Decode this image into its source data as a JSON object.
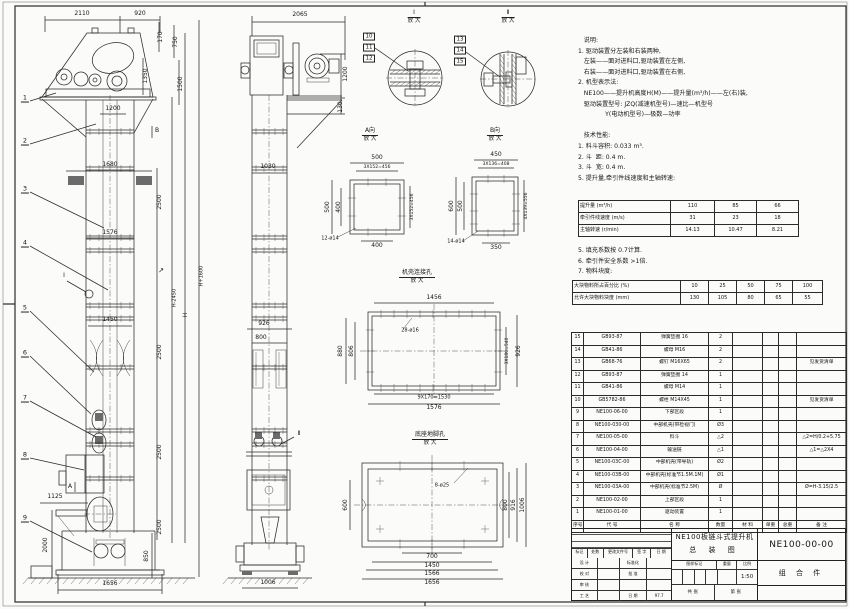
{
  "colors": {
    "line": "#2b2b2b",
    "paper": "#fbfbf9",
    "bracket_fill": "#6b6b6b"
  },
  "notes": {
    "block1_lines": [
      "   说明:",
      "1. 驱动装置分左装和右装两种,",
      "   左装——面对进料口,驱动装置在左侧,",
      "   右装——面对进料口,驱动装置在右侧,",
      "2. 机型表示法:",
      "   NE100——提升机高度H(M)——提升量(m³/h)——左(右)装,",
      "   驱动装置型号: JZQ(减速机型号)—速比—机型号",
      "              Y(电动机型号)—极数—功率",
      "",
      "   技术性能:",
      "1. 料斗容积: 0.033 m³.",
      "2. 斗  距: 0.4 m.",
      "3. 斗  宽: 0.4 m.",
      "5. 提升量,牵引件线速度和主轴转速:"
    ],
    "block2_lines": [
      "5. 填充系数按 0.7计算.",
      "6. 牵引件安全系数 >1倍.",
      "7. 物料块度:"
    ]
  },
  "chart_data": [
    {
      "type": "table",
      "title": "提升量,牵引件线速度和主轴转速",
      "rows": [
        [
          "提升量 (m³/h)",
          "110",
          "85",
          "66"
        ],
        [
          "牵引件线速度 (m/s)",
          "31",
          "23",
          "18"
        ],
        [
          "主轴转速 (r/min)",
          "14.13",
          "10.47",
          "8.21"
        ]
      ]
    },
    {
      "type": "table",
      "title": "物料块度",
      "rows": [
        [
          "大块物料所占百分比 (%)",
          "10",
          "25",
          "50",
          "75",
          "100"
        ],
        [
          "允许大块物料块度 (mm)",
          "130",
          "105",
          "80",
          "65",
          "55"
        ]
      ]
    }
  ],
  "bom": {
    "header": [
      "序号",
      "代 号",
      "名  称",
      "数量",
      "材 料",
      "单重",
      "总重",
      "备 注"
    ],
    "col_widths": [
      12,
      57,
      68,
      24,
      30,
      16,
      18,
      50
    ],
    "rows": [
      [
        "15",
        "GB93-87",
        "弹簧垫圈 16",
        "2",
        "",
        "",
        "",
        ""
      ],
      [
        "14",
        "GB41-86",
        "螺母 M16",
        "2",
        "",
        "",
        "",
        ""
      ],
      [
        "13",
        "GB68-76",
        "螺钉 M16X65",
        "2",
        "",
        "",
        "",
        "见发货清单"
      ],
      [
        "12",
        "GB93-87",
        "弹簧垫圈 14",
        "1",
        "",
        "",
        "",
        ""
      ],
      [
        "11",
        "GB41-86",
        "螺母 M14",
        "1",
        "",
        "",
        "",
        ""
      ],
      [
        "10",
        "GB5782-86",
        "螺栓 M14X45",
        "1",
        "",
        "",
        "",
        "见发货清单"
      ],
      [
        "9",
        "NE100-06-00",
        "下部区段",
        "1",
        "",
        "",
        "",
        ""
      ],
      [
        "8",
        "NE100-030-00",
        "中部机壳(带检视门)",
        "Ø3",
        "",
        "",
        "",
        ""
      ],
      [
        "7",
        "NE100-05-00",
        "料斗",
        "△2",
        "",
        "",
        "",
        "△2=H/0.2+5.75"
      ],
      [
        "6",
        "NE100-04-00",
        "输送链",
        "△1",
        "",
        "",
        "",
        "△1=△2X4"
      ],
      [
        "5",
        "NE100-03C-00",
        "中部机壳(带导轨)",
        "Ø2",
        "",
        "",
        "",
        ""
      ],
      [
        "4",
        "NE100-03B-00",
        "中部机壳(标准节1.5M.1M)",
        "Ø1",
        "",
        "",
        "",
        ""
      ],
      [
        "3",
        "NE100-03A-00",
        "中部机壳(标准节2.5M)",
        "Ø",
        "",
        "",
        "",
        "Ø=H-3.15/2.5"
      ],
      [
        "2",
        "NE100-02-00",
        "上部区段",
        "1",
        "",
        "",
        "",
        ""
      ],
      [
        "1",
        "NE100-01-00",
        "驱动装置",
        "1",
        "",
        "",
        "",
        ""
      ]
    ]
  },
  "title_block": {
    "product": "NE100板链斗式提升机",
    "drawing": "总 装 图",
    "doc_no": "NE100-00-00",
    "part_type": "组 合 件",
    "mark_label": "图样标记",
    "weight_label": "重量",
    "scale_label": "比例",
    "scale": "1:50",
    "sheets_left": "共  张",
    "sheets_right": "第  张",
    "rev_header": [
      "标记",
      "处数",
      "更改文件号",
      "签 字",
      "日 期"
    ],
    "rev_col_widths": [
      16,
      16,
      30,
      18,
      20
    ],
    "sign_col_widths": [
      26,
      22,
      28,
      24
    ],
    "sign_rows": [
      [
        "设 计",
        "",
        "标准化",
        ""
      ],
      [
        "校 对",
        "",
        "批 准",
        ""
      ],
      [
        "审 核",
        "",
        "",
        ""
      ],
      [
        "工 艺",
        "",
        "日 期",
        "97.7"
      ]
    ],
    "date": "97.7"
  },
  "captions": [
    {
      "t": "I",
      "s": "放 大",
      "x": 414,
      "y": 9
    },
    {
      "t": "Ⅱ",
      "s": "放 大",
      "x": 508,
      "y": 9
    },
    {
      "t": "A向",
      "s": "放 大",
      "x": 370,
      "y": 127
    },
    {
      "t": "B向",
      "s": "放 大",
      "x": 495,
      "y": 127
    },
    {
      "t": "机壳连接孔",
      "s": "放 大",
      "x": 417,
      "y": 269
    },
    {
      "t": "底座地脚孔",
      "s": "放 大",
      "x": 430,
      "y": 431
    }
  ],
  "balloons": {
    "plain": [
      [
        "1",
        25,
        99
      ],
      [
        "2",
        25,
        142
      ],
      [
        "3",
        25,
        190
      ],
      [
        "4",
        25,
        244
      ],
      [
        "5",
        25,
        309
      ],
      [
        "6",
        25,
        354
      ],
      [
        "7",
        25,
        399
      ],
      [
        "8",
        25,
        456
      ],
      [
        "9",
        25,
        519
      ]
    ],
    "boxed": [
      [
        "10",
        369,
        37
      ],
      [
        "11",
        369,
        48
      ],
      [
        "12",
        369,
        59
      ],
      [
        "13",
        460,
        40
      ],
      [
        "14",
        460,
        51
      ],
      [
        "15",
        460,
        62
      ]
    ]
  },
  "labels": [
    [
      "2110",
      82,
      14
    ],
    [
      "920",
      140,
      14
    ],
    [
      "170",
      161,
      37,
      1
    ],
    [
      "750",
      176,
      42,
      1
    ],
    [
      "1350",
      146,
      76,
      1
    ],
    [
      "1500",
      181,
      84,
      1
    ],
    [
      "1200",
      113,
      109
    ],
    [
      "1680",
      110,
      165
    ],
    [
      "1576",
      110,
      233
    ],
    [
      "1450",
      110,
      320
    ],
    [
      "2500",
      160,
      202,
      1
    ],
    [
      "2500",
      160,
      352,
      1
    ],
    [
      "2500",
      160,
      452,
      1
    ],
    [
      "2500",
      160,
      527,
      1
    ],
    [
      "↗",
      161,
      271,
      0,
      7
    ],
    [
      "H-2450",
      175,
      298,
      1,
      5
    ],
    [
      "H",
      186,
      315,
      1
    ],
    [
      "H+1600",
      202,
      276,
      1,
      5
    ],
    [
      "1125",
      55,
      497
    ],
    [
      "2000",
      46,
      545,
      1
    ],
    [
      "850",
      147,
      556,
      1
    ],
    [
      "1656",
      110,
      584
    ],
    [
      "A",
      70,
      487
    ],
    [
      "B",
      157,
      131
    ],
    [
      "I",
      64,
      276
    ],
    [
      "2065",
      300,
      15
    ],
    [
      "1200",
      346,
      74,
      1
    ],
    [
      "130",
      341,
      107,
      1
    ],
    [
      "1030",
      268,
      167
    ],
    [
      "926",
      264,
      324
    ],
    [
      "800",
      261,
      338
    ],
    [
      "1006",
      268,
      583
    ],
    [
      "Ⅱ",
      299,
      434
    ],
    [
      "500",
      377,
      158
    ],
    [
      "3X152=456",
      377,
      168,
      0,
      4.5
    ],
    [
      "500",
      328,
      207,
      1
    ],
    [
      "400",
      339,
      207,
      1
    ],
    [
      "3X152=456",
      413,
      207,
      1,
      4.5
    ],
    [
      "12-ø14",
      330,
      239,
      0,
      5
    ],
    [
      "400",
      377,
      246
    ],
    [
      "450",
      496,
      155
    ],
    [
      "3X136=408",
      496,
      165,
      0,
      4.5
    ],
    [
      "600",
      452,
      206,
      1
    ],
    [
      "500",
      461,
      206,
      1
    ],
    [
      "4X139=556",
      527,
      206,
      1,
      4.5
    ],
    [
      "14-ø14",
      456,
      242,
      0,
      5
    ],
    [
      "350",
      496,
      248
    ],
    [
      "1456",
      434,
      298
    ],
    [
      "28-ø16",
      410,
      331,
      0,
      5
    ],
    [
      "880",
      341,
      351,
      1
    ],
    [
      "806",
      352,
      351,
      1
    ],
    [
      "3X180=540",
      508,
      351,
      1,
      4.5
    ],
    [
      "926",
      519,
      351,
      1
    ],
    [
      "9X170=1530",
      434,
      398,
      0,
      5
    ],
    [
      "1576",
      434,
      408
    ],
    [
      "8-ø25",
      442,
      486,
      0,
      5
    ],
    [
      "600",
      346,
      505,
      1
    ],
    [
      "800",
      506,
      505,
      1
    ],
    [
      "916",
      514,
      505,
      1
    ],
    [
      "1006",
      523,
      505,
      1
    ],
    [
      "700",
      432,
      557
    ],
    [
      "1450",
      432,
      566
    ],
    [
      "1566",
      432,
      574
    ],
    [
      "1656",
      432,
      583
    ]
  ],
  "geometry": {
    "front_joints": {
      "x1": 86,
      "x2": 134,
      "ticks": [
        90,
        99,
        121,
        130
      ],
      "ys": [
        130,
        167,
        236,
        249,
        304,
        317,
        366,
        429,
        443,
        477
      ]
    },
    "side_joints": {
      "x1": 252,
      "x2": 287,
      "ticks": [
        256,
        264,
        275,
        283
      ],
      "ys": [
        130,
        167,
        236,
        249,
        304,
        317,
        366,
        429,
        443,
        477
      ]
    },
    "hatches": [
      {
        "x": 390,
        "y": 70,
        "w": 50,
        "h": 4,
        "step": 5,
        "o": "h"
      },
      {
        "x": 390,
        "y": 82,
        "w": 50,
        "h": 4,
        "step": 5,
        "o": "h"
      },
      {
        "x": 500,
        "y": 54,
        "w": 4,
        "h": 50,
        "step": 5,
        "o": "v"
      },
      {
        "x": 512,
        "y": 54,
        "w": 4,
        "h": 50,
        "step": 5,
        "o": "v"
      },
      {
        "x": 28,
        "y": 578,
        "w": 167,
        "step": 8,
        "o": "g"
      },
      {
        "x": 228,
        "y": 578,
        "w": 84,
        "step": 8,
        "o": "g"
      }
    ],
    "wallticks": [
      {
        "xs": [
          368,
          386
        ],
        "y1": 178,
        "y2": 186
      },
      {
        "xs": [
          368,
          386
        ],
        "y1": 228,
        "y2": 236
      },
      {
        "ys": [
          198,
          216
        ],
        "x1": 348,
        "x2": 356
      },
      {
        "ys": [
          198,
          216
        ],
        "x1": 398,
        "x2": 406
      },
      {
        "xs": [
          488,
          504
        ],
        "y1": 175,
        "y2": 183
      },
      {
        "xs": [
          488,
          504
        ],
        "y1": 229,
        "y2": 237
      },
      {
        "ys": [
          194,
          211,
          224
        ],
        "x1": 470,
        "x2": 478
      },
      {
        "ys": [
          194,
          211,
          224
        ],
        "x1": 512,
        "x2": 520
      },
      {
        "xs": [
          381,
          394,
          407,
          420,
          433,
          446,
          459,
          472,
          485
        ],
        "y1": 310,
        "y2": 318
      },
      {
        "xs": [
          381,
          394,
          407,
          420,
          433,
          446,
          459,
          472,
          485
        ],
        "y1": 384,
        "y2": 392
      },
      {
        "ys": [
          330,
          351,
          372
        ],
        "x1": 366,
        "x2": 374
      },
      {
        "ys": [
          330,
          351,
          372
        ],
        "x1": 494,
        "x2": 502
      },
      {
        "xs": [
          400,
          432,
          464
        ],
        "y1": 461,
        "y2": 471
      },
      {
        "xs": [
          400,
          432,
          464
        ],
        "y1": 539,
        "y2": 549
      }
    ]
  }
}
